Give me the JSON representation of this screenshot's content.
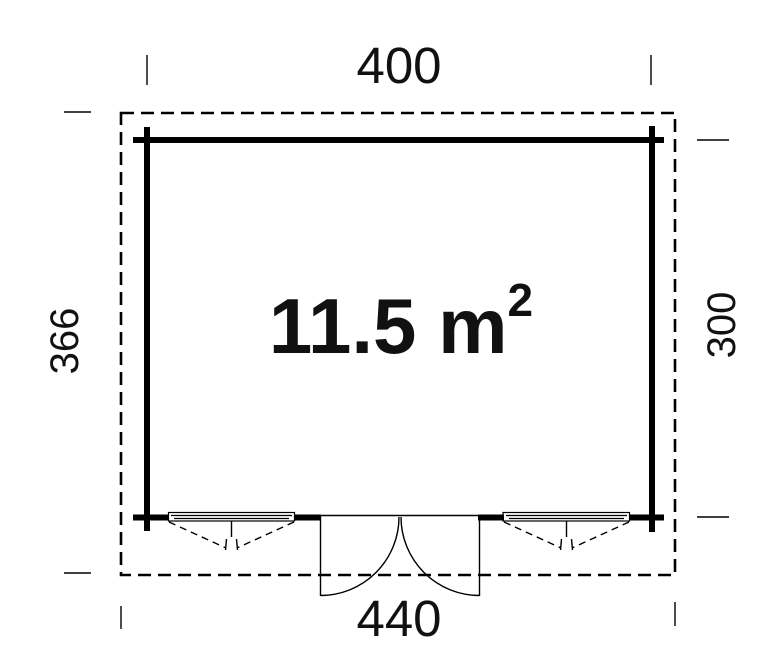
{
  "drawing": {
    "type": "floor-plan",
    "area_label": {
      "value": "11.5 m",
      "exponent": "2"
    },
    "dimensions": {
      "top": "400",
      "left": "366",
      "right": "300",
      "bottom": "440"
    },
    "features": {
      "windows": [
        "bottom-left-window",
        "bottom-right-window"
      ],
      "door": "bottom-center-double-door"
    },
    "colors": {
      "line": "#000000",
      "text": "#111111",
      "background": "#ffffff"
    }
  }
}
